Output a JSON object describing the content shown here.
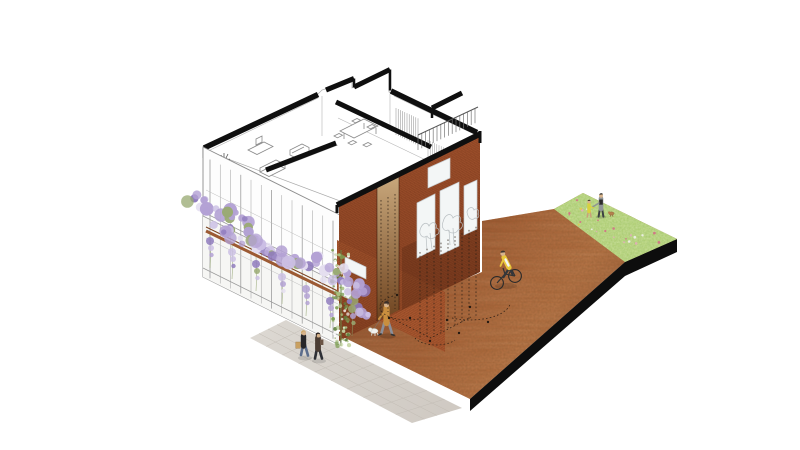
{
  "scene": {
    "kind": "axonometric-architectural-illustration",
    "colors": {
      "background": "#ffffff",
      "linework": "#8d8d8d",
      "linework_light": "#b5b5b5",
      "poche_black": "#0f0f0f",
      "brick": "#9d4f2b",
      "brick_front": "#a8572f",
      "brick_mortar": "#7d3a1c",
      "door_top": "#c9a87c",
      "door_bottom": "#6f4420",
      "window": "#f3f6f6",
      "window_frame": "#c8cdd0",
      "tree_sketch": "#b9bfc2",
      "plaza_rust": "#a2582e",
      "plaza_dark": "#7e4023",
      "plaza_light": "#b26b3c",
      "sidewalk": "#dcd8d2",
      "sidewalk_dark": "#cfc9c2",
      "sidewalk_joint": "#c2bcb4",
      "grass": "#a6c964",
      "grass_dark": "#7fa84b",
      "slab_edge": "#0d0d0d",
      "wisteria_main": "#b3a1d4",
      "wisteria_pale": "#cbbfe4",
      "wisteria_deep": "#8f7bbd",
      "wisteria_white": "#e4def0",
      "foliage_green": "#9aaa74",
      "ivy_green": "#7e9e54",
      "pergola_beam": "#9c5a33",
      "dashed_line": "#2b1f15",
      "skin": "#d7b38c",
      "jacket_yellow": "#e9c73b",
      "coat_ochre": "#c98f3f",
      "jacket_black": "#26262a",
      "jacket_brown": "#4a3c33",
      "denim_blue": "#5c6d8c",
      "grey_top": "#8f9496",
      "child_shirt": "#d8d23e",
      "dog_white": "#f2f2ee",
      "dog_brown": "#b5804e",
      "bag_tan": "#c9a061"
    },
    "elements": [
      "cutaway-building-linework",
      "interior-furniture",
      "wisteria-pergola",
      "ivy-column",
      "brick-facade",
      "door-recess",
      "facade-windows",
      "roof-railing",
      "corten-plaza",
      "sidewalk",
      "lawn",
      "slab-edge",
      "projection-dashed-lines"
    ],
    "figures": [
      {
        "name": "pedestrian-pair",
        "where": "sidewalk lower-left"
      },
      {
        "name": "dog-walker",
        "where": "plaza in front of brick facade"
      },
      {
        "name": "cyclist",
        "where": "plaza centre-right"
      },
      {
        "name": "family-with-child-and-dog",
        "where": "lawn upper-right"
      }
    ]
  }
}
